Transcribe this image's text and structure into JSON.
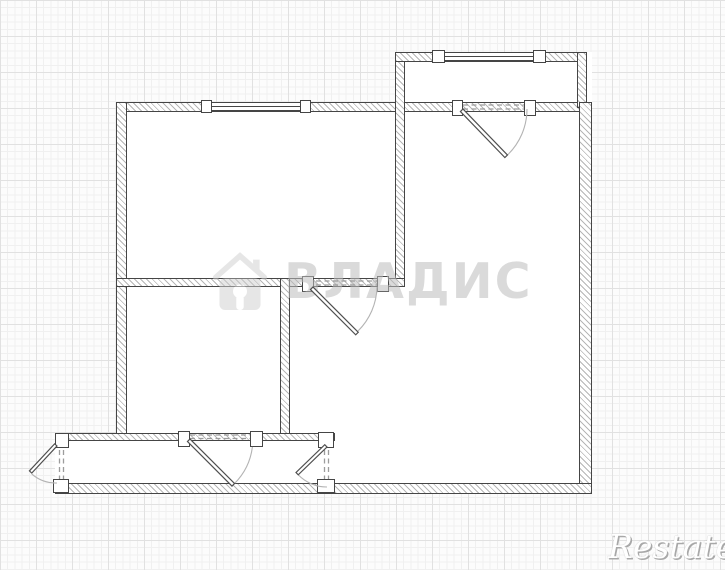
{
  "watermarks": {
    "vladis_text": "ВЛАДИС",
    "restate_text": "Restate"
  },
  "icons": {
    "vladis_logo": "house-keyhole-icon"
  },
  "colors": {
    "wall-line": "#454545",
    "hatch": "#b6b6b6",
    "paper": "#fcfcfc",
    "grid-minor": "#f0f0f0",
    "grid-major": "#e1e1e1",
    "dash": "#9c9c9c",
    "arc": "#b3b3b3",
    "wm": "#bdbdbd",
    "restate-shadow": "#a8a8a8"
  }
}
